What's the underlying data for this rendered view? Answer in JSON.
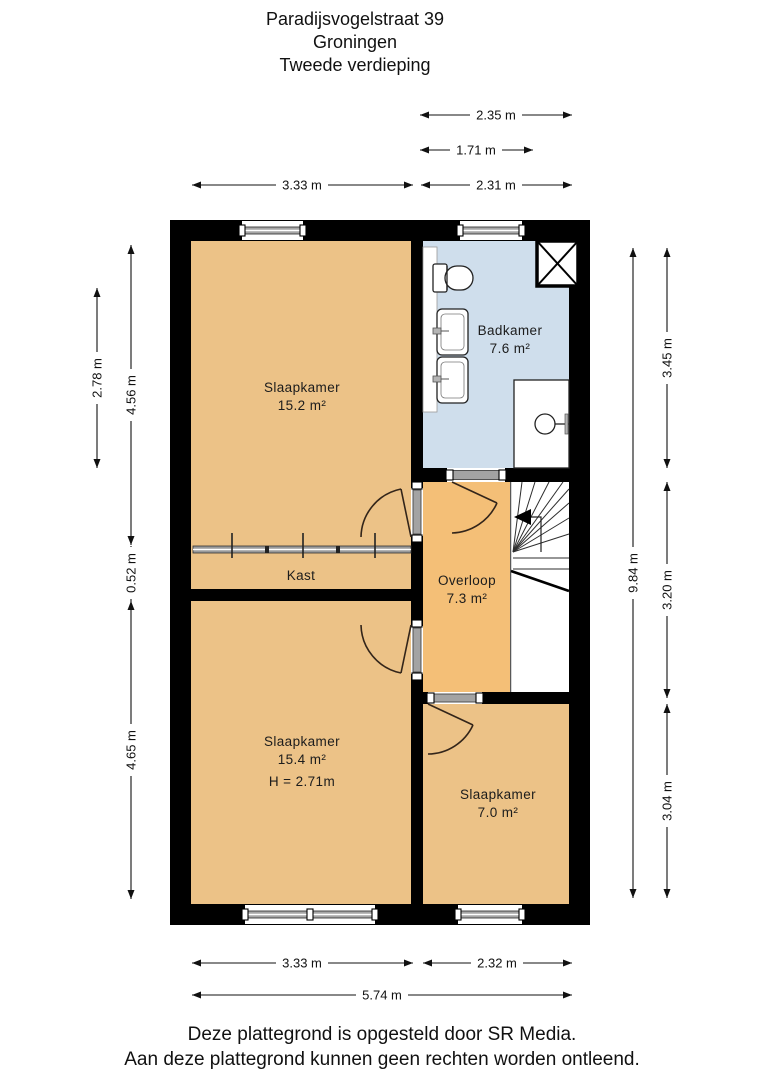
{
  "title": {
    "address": "Paradijsvogelstraat 39",
    "city": "Groningen",
    "floor": "Tweede verdieping"
  },
  "rooms": {
    "bedroom1": {
      "name": "Slaapkamer",
      "area": "15.2 m²"
    },
    "bathroom": {
      "name": "Badkamer",
      "area": "7.6 m²"
    },
    "closet": {
      "name": "Kast"
    },
    "landing": {
      "name": "Overloop",
      "area": "7.3 m²"
    },
    "bedroom2": {
      "name": "Slaapkamer",
      "area": "15.4 m²",
      "height_label": "H = 2.71m"
    },
    "bedroom3": {
      "name": "Slaapkamer",
      "area": "7.0 m²"
    }
  },
  "dimensions": {
    "top": {
      "d235": "2.35 m",
      "d171": "1.71 m",
      "d333": "3.33 m",
      "d231": "2.31 m"
    },
    "left": {
      "d278": "2.78 m",
      "d456": "4.56 m",
      "d052": "0.52 m",
      "d465": "4.65 m"
    },
    "right": {
      "d345": "3.45 m",
      "d984": "9.84 m",
      "d320": "3.20 m",
      "d304": "3.04 m"
    },
    "bottom": {
      "d333": "3.33 m",
      "d232": "2.32 m",
      "d574": "5.74 m"
    }
  },
  "footer": {
    "line1": "Deze plattegrond is opgesteld door SR Media.",
    "line2": "Aan deze plattegrond kunnen geen rechten worden ontleend."
  },
  "colors": {
    "wall": "#000000",
    "room": "#ecc287",
    "hall": "#f4bf77",
    "bathroom": "#cfdeec"
  }
}
